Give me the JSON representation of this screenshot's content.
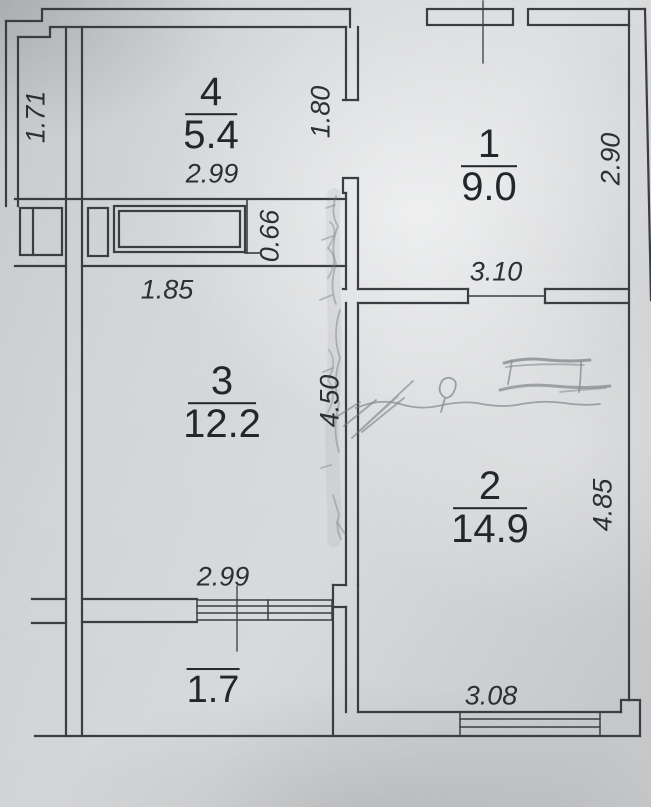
{
  "plan": {
    "rooms": [
      {
        "number": "4",
        "area": "5.4"
      },
      {
        "number": "1",
        "area": "9.0"
      },
      {
        "number": "3",
        "area": "12.2"
      },
      {
        "number": "2",
        "area": "14.9"
      },
      {
        "number": "",
        "area": "1.7"
      }
    ],
    "dimensions": {
      "loggia_side": "1.71",
      "room4_width": "2.99",
      "room4_room1_opening": "1.80",
      "room1_side": "2.90",
      "room1_width": "3.10",
      "closet_row_width": "1.85",
      "closet_depth": "0.66",
      "room3_side": "4.50",
      "room2_side": "4.85",
      "room3_width": "2.99",
      "room2_width": "3.08"
    },
    "colors": {
      "paper": "#d6d8da",
      "ink": "#3a3e42",
      "pencil": "#73777b",
      "text": "#24272a"
    }
  }
}
